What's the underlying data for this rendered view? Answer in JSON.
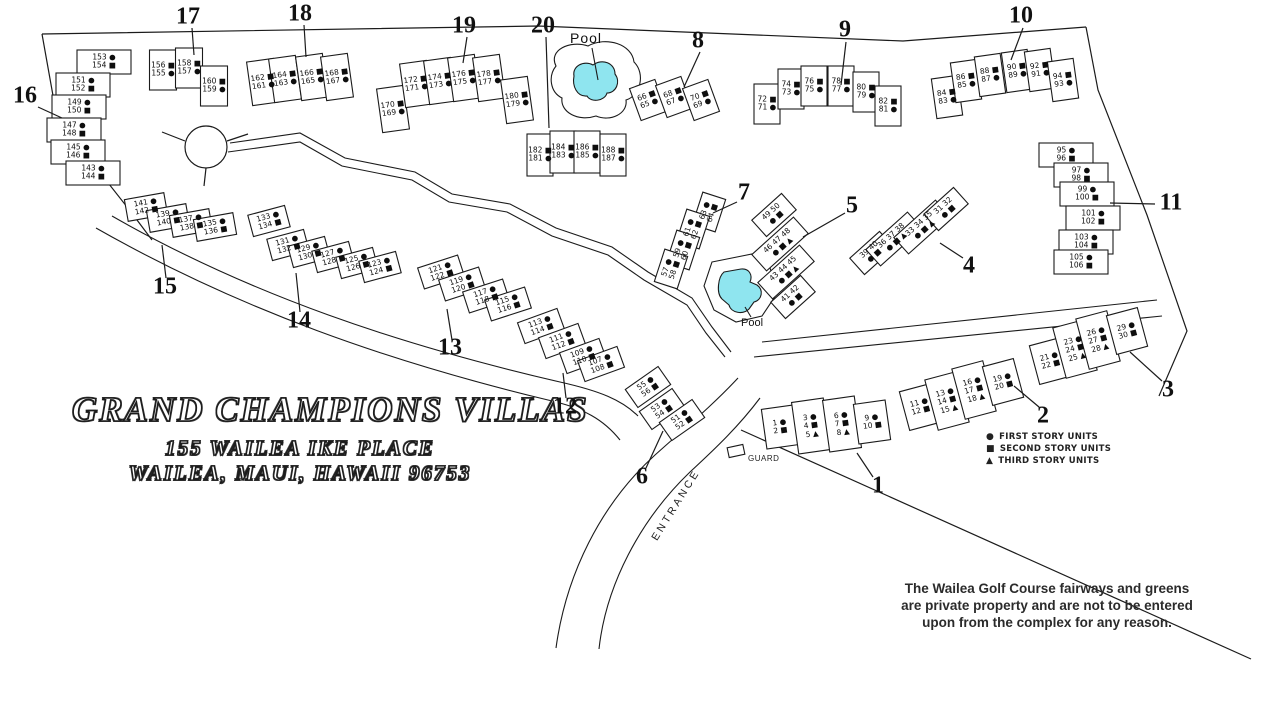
{
  "title": {
    "name": "GRAND CHAMPIONS VILLAS",
    "address": "155 WAILEA IKE PLACE",
    "city": "WAILEA, MAUI, HAWAII 96753"
  },
  "legend": {
    "items": [
      {
        "symbol": "●",
        "label": "FIRST STORY UNITS"
      },
      {
        "symbol": "■",
        "label": "SECOND STORY UNITS"
      },
      {
        "symbol": "▲",
        "label": "THIRD STORY UNITS"
      }
    ]
  },
  "notice": {
    "line1": "The Wailea Golf Course fairways and greens",
    "line2": "are private property and are not to be entered",
    "line3": "upon from the complex for any reason."
  },
  "labels": {
    "pool_upper": "Pool",
    "pool_lower": "Pool",
    "entrance": "ENTRANCE",
    "guard": "GUARD"
  },
  "colors": {
    "pool": "#8fe5ef",
    "ink": "#1b1b1b"
  },
  "buildings": [
    {
      "number": "1",
      "units": [
        [
          "1 ●",
          "2 ■"
        ],
        [
          "3 ●",
          "4 ■",
          "5 ▲"
        ],
        [
          "6 ●",
          "7 ■",
          "8 ▲"
        ],
        [
          "9 ●",
          "10 ■"
        ]
      ]
    },
    {
      "number": "2",
      "units": [
        [
          "11 ●",
          "12 ■"
        ],
        [
          "13 ●",
          "14 ■",
          "15 ▲"
        ],
        [
          "16 ●",
          "17 ■",
          "18 ▲"
        ],
        [
          "19 ●",
          "20 ■"
        ]
      ]
    },
    {
      "number": "3",
      "units": [
        [
          "21 ●",
          "22 ■"
        ],
        [
          "23 ●",
          "24 ■",
          "25 ▲"
        ],
        [
          "26 ●",
          "27 ■",
          "28 ▲"
        ],
        [
          "29 ●",
          "30 ■"
        ]
      ]
    },
    {
      "number": "4",
      "units": [
        [
          "39 40",
          "● ■"
        ],
        [
          "36 37 38",
          "● ■ ▲"
        ],
        [
          "33 34 35",
          "● ■ ▲"
        ],
        [
          "31 32",
          "● ■"
        ]
      ]
    },
    {
      "number": "5",
      "units": [
        [
          "49 50",
          "● ■"
        ],
        [
          "46 47 48",
          "● ■ ▲"
        ],
        [
          "43 44 45",
          "● ■ ▲"
        ],
        [
          "41 42",
          "● ■"
        ]
      ]
    },
    {
      "number": "6",
      "units": [
        [
          "55 ●",
          "56 ■"
        ],
        [
          "53 ●",
          "54 ■"
        ],
        [
          "51 ●",
          "52 ■"
        ]
      ]
    },
    {
      "number": "7",
      "units": [
        [
          "63 ●",
          "64 ■"
        ],
        [
          "61 ●",
          "62 ■"
        ],
        [
          "59 ●",
          "60 ■"
        ],
        [
          "57 ●",
          "58 ■"
        ]
      ]
    },
    {
      "number": "8",
      "units": [
        [
          "66 ■",
          "65 ●"
        ],
        [
          "68 ■",
          "67 ●"
        ],
        [
          "70 ■",
          "69 ●"
        ]
      ]
    },
    {
      "number": "9",
      "units": [
        [
          "72 ■",
          "71 ●"
        ],
        [
          "74 ■",
          "73 ●"
        ],
        [
          "76 ■",
          "75 ●"
        ],
        [
          "78 ■",
          "77 ●"
        ],
        [
          "80 ■",
          "79 ●"
        ],
        [
          "82 ■",
          "81 ●"
        ]
      ]
    },
    {
      "number": "10",
      "units": [
        [
          "84 ■",
          "83 ●"
        ],
        [
          "86 ■",
          "85 ●"
        ],
        [
          "88 ■",
          "87 ●"
        ],
        [
          "90 ■",
          "89 ●"
        ],
        [
          "92 ■",
          "91 ●"
        ],
        [
          "94 ■",
          "93 ●"
        ]
      ]
    },
    {
      "number": "11",
      "units": [
        [
          "95 ●",
          "96 ■"
        ],
        [
          "97 ●",
          "98 ■"
        ],
        [
          "99 ●",
          "100 ■"
        ],
        [
          "101 ●",
          "102 ■"
        ],
        [
          "103 ●",
          "104 ■"
        ],
        [
          "105 ●",
          "106 ■"
        ]
      ]
    },
    {
      "number": "12",
      "units": [
        [
          "113 ●",
          "114 ■"
        ],
        [
          "111 ●",
          "112 ■"
        ],
        [
          "109 ●",
          "110 ■"
        ],
        [
          "107 ●",
          "108 ■"
        ]
      ]
    },
    {
      "number": "13",
      "units": [
        [
          "121 ●",
          "122 ■"
        ],
        [
          "119 ●",
          "120 ■"
        ],
        [
          "117 ●",
          "118 ■"
        ],
        [
          "115 ●",
          "116 ■"
        ]
      ]
    },
    {
      "number": "14",
      "units": [
        [
          "133 ●",
          "134 ■"
        ],
        [
          "131 ●",
          "132 ■"
        ],
        [
          "129 ●",
          "130 ■"
        ],
        [
          "127 ●",
          "128 ■"
        ],
        [
          "125 ●",
          "126 ■"
        ],
        [
          "123 ●",
          "124 ■"
        ]
      ]
    },
    {
      "number": "15",
      "units": [
        [
          "141 ●",
          "142 ■"
        ],
        [
          "139 ●",
          "140 ■"
        ],
        [
          "137 ●",
          "138 ■"
        ],
        [
          "135 ●",
          "136 ■"
        ]
      ]
    },
    {
      "number": "16",
      "units": [
        [
          "153 ●",
          "154 ■"
        ],
        [
          "151 ●",
          "152 ■"
        ],
        [
          "149 ●",
          "150 ■"
        ],
        [
          "147 ●",
          "148 ■"
        ],
        [
          "145 ●",
          "146 ■"
        ],
        [
          "143 ●",
          "144 ■"
        ]
      ]
    },
    {
      "number": "17",
      "units": [
        [
          "156 ■",
          "155 ●"
        ],
        [
          "158 ■",
          "157 ●"
        ],
        [
          "160 ■",
          "159 ●"
        ]
      ]
    },
    {
      "number": "18",
      "units": [
        [
          "162 ■",
          "161 ●"
        ],
        [
          "164 ■",
          "163 ●"
        ],
        [
          "166 ■",
          "165 ●"
        ],
        [
          "168 ■",
          "167 ●"
        ]
      ]
    },
    {
      "number": "19",
      "units": [
        [
          "170 ■",
          "169 ●"
        ],
        [
          "172 ■",
          "171 ●"
        ],
        [
          "174 ■",
          "173 ●"
        ],
        [
          "176 ■",
          "175 ●"
        ],
        [
          "178 ■",
          "177 ●"
        ],
        [
          "180 ■",
          "179 ●"
        ]
      ]
    },
    {
      "number": "20",
      "units": [
        [
          "182 ■",
          "181 ●"
        ],
        [
          "184 ■",
          "183 ●"
        ],
        [
          "186 ■",
          "185 ●"
        ],
        [
          "188 ■",
          "187 ●"
        ]
      ]
    }
  ]
}
